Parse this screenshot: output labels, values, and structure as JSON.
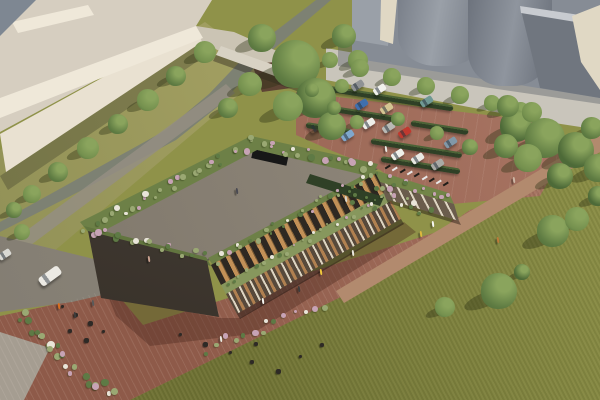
{
  "meta": {
    "type": "architectural-aerial-rendering",
    "description": "Aerial visualization of an elongated two-storey timber-bay building with a planted green roof, outdoor terrace, brick promenade, parking lot with hedgerows, stream with bridge, industrial silos and a large lawn"
  },
  "palette": {
    "grassA": "#6e7134",
    "grassB": "#8f9249",
    "grassPath": "#b28a6e",
    "brickA": "#8e5a49",
    "brickB": "#aa7765",
    "road": "#837d72",
    "roadLight": "#948e83",
    "cornerPath": "#a59d91",
    "greenwayA": "#b3ad6c",
    "greenwayB": "#8f8f55",
    "water": "#7d8173",
    "creamRoof": "#d6cec0",
    "creamLight": "#efe8d9",
    "creamFace": "#e9e1d1",
    "annex": "#cbc4b4",
    "bridge": "#d8d2c4",
    "hut": "#5e4434",
    "siloA": "#868c95",
    "siloB": "#70767f",
    "siloC": "#9aa0a8",
    "siloLight": "#c8cbd0",
    "siloCream": "#e0d8c4",
    "apron": "#c9c5bb",
    "roofDeckA": "#958d80",
    "roofDeckB": "#7d7569",
    "roofEdge": "#5f584e",
    "roofBand": "#6d8047",
    "skylight": "#171717",
    "timber": "#c29057",
    "timberDark": "#7d5c34",
    "midBand": "#87975d",
    "colonnade": "#57493b",
    "pillar": "#ddd4c1",
    "arch": "#b08050",
    "wingTop": "#728548",
    "wingBase": "#6a5c4c",
    "hedgeDark": "#2f4026",
    "hedgeLight": "#4c6337",
    "treeDark": "#4d6a38",
    "treeMid": "#5f7c43",
    "treeLight": "#74904e",
    "treeHi": "#8aa45d",
    "treeShadow": "rgba(43,48,18,0.38)",
    "shrubPink": "#c7a3b5",
    "shrubWhite": "#e9e5d9",
    "shrubSage": "#9aa873",
    "shrubGreen": "#5e7a45",
    "furniture": "#2e2a26",
    "bikeDark": "#1f1c18",
    "bikeLight": "#e8e8e8"
  },
  "scene": {
    "trees": [
      [
        262,
        38,
        14,
        1
      ],
      [
        296,
        64,
        24,
        1
      ],
      [
        316,
        98,
        20,
        0
      ],
      [
        288,
        106,
        15,
        2
      ],
      [
        332,
        126,
        14,
        1
      ],
      [
        344,
        36,
        12,
        1
      ],
      [
        358,
        60,
        10,
        2
      ],
      [
        250,
        84,
        12,
        2
      ],
      [
        228,
        108,
        10,
        1
      ],
      [
        205,
        52,
        11,
        2
      ],
      [
        176,
        76,
        10,
        1
      ],
      [
        148,
        100,
        11,
        2
      ],
      [
        118,
        124,
        10,
        1
      ],
      [
        88,
        148,
        11,
        2
      ],
      [
        58,
        172,
        10,
        1
      ],
      [
        32,
        194,
        9,
        2
      ],
      [
        14,
        210,
        8,
        1
      ],
      [
        22,
        232,
        8,
        2
      ],
      [
        330,
        60,
        8,
        2
      ],
      [
        360,
        68,
        9,
        2
      ],
      [
        392,
        77,
        9,
        2
      ],
      [
        426,
        86,
        9,
        2
      ],
      [
        460,
        95,
        9,
        2
      ],
      [
        492,
        103,
        8,
        2
      ],
      [
        521,
        110,
        8,
        2
      ],
      [
        312,
        90,
        7,
        1
      ],
      [
        342,
        86,
        7,
        2
      ],
      [
        334,
        108,
        7,
        1
      ],
      [
        357,
        122,
        7,
        2
      ],
      [
        398,
        119,
        7,
        1
      ],
      [
        437,
        133,
        7,
        2
      ],
      [
        470,
        147,
        8,
        1
      ],
      [
        516,
        126,
        16,
        0
      ],
      [
        545,
        138,
        20,
        1
      ],
      [
        576,
        150,
        18,
        0
      ],
      [
        598,
        168,
        14,
        1
      ],
      [
        528,
        158,
        14,
        2
      ],
      [
        506,
        146,
        12,
        1
      ],
      [
        560,
        176,
        13,
        0
      ],
      [
        592,
        128,
        11,
        1
      ],
      [
        508,
        106,
        11,
        1
      ],
      [
        532,
        112,
        10,
        2
      ],
      [
        598,
        196,
        10,
        0
      ],
      [
        553,
        231,
        16,
        1
      ],
      [
        577,
        219,
        12,
        2
      ],
      [
        499,
        291,
        18,
        1
      ],
      [
        445,
        307,
        10,
        2
      ],
      [
        522,
        272,
        8,
        0
      ]
    ],
    "hedges": [
      [
        305,
        82,
        150
      ],
      [
        333,
        106,
        66
      ],
      [
        411,
        120,
        58
      ],
      [
        306,
        122,
        46
      ],
      [
        371,
        138,
        92
      ],
      [
        381,
        156,
        80
      ]
    ],
    "shrub_bands": [
      [
        86,
        228,
        252,
        142,
        26,
        6,
        1.0
      ],
      [
        252,
        142,
        372,
        168,
        18,
        5,
        1.0
      ],
      [
        212,
        262,
        374,
        172,
        24,
        4,
        0.8
      ],
      [
        88,
        230,
        206,
        258,
        16,
        5,
        0.9
      ],
      [
        222,
        286,
        386,
        196,
        22,
        3,
        0.6
      ],
      [
        376,
        176,
        450,
        198,
        10,
        4,
        0.7
      ],
      [
        18,
        316,
        62,
        356,
        12,
        8,
        1.1
      ],
      [
        62,
        356,
        112,
        398,
        12,
        8,
        1.1
      ],
      [
        200,
        350,
        330,
        302,
        14,
        6,
        0.9
      ],
      [
        336,
        188,
        374,
        208,
        8,
        5,
        0.8
      ],
      [
        378,
        186,
        430,
        216,
        12,
        5,
        0.8
      ]
    ],
    "cars": [
      [
        300,
        97,
        "#9d9d99"
      ],
      [
        357,
        85,
        "#8f9294"
      ],
      [
        379,
        89,
        "#f1f1ec"
      ],
      [
        361,
        104,
        "#3f6fae"
      ],
      [
        386,
        108,
        "#d4c491"
      ],
      [
        426,
        101,
        "#6f9894"
      ],
      [
        315,
        127,
        "#ececе7"
      ],
      [
        347,
        135,
        "#7fa7cc"
      ],
      [
        368,
        123,
        "#efefe9"
      ],
      [
        388,
        127,
        "#b9b9b4"
      ],
      [
        404,
        132,
        "#c0392f"
      ],
      [
        450,
        142,
        "#8198a8"
      ],
      [
        397,
        154,
        "#f0f0ea"
      ],
      [
        417,
        158,
        "#e9e9e3"
      ],
      [
        437,
        164,
        "#a9aaa5"
      ],
      [
        4,
        254,
        "#d9d9d4"
      ]
    ],
    "van": [
      50,
      276,
      "#eceae4"
    ],
    "bikes": {
      "x": 387,
      "y": 164,
      "count": 9,
      "dx": 7.3,
      "dy": 2.1
    },
    "furniture": [
      [
        62,
        306
      ],
      [
        76,
        315
      ],
      [
        90,
        323
      ],
      [
        103,
        331
      ],
      [
        70,
        331
      ],
      [
        86,
        340
      ],
      [
        230,
        352
      ],
      [
        252,
        362
      ],
      [
        278,
        371
      ],
      [
        300,
        356
      ],
      [
        322,
        345
      ],
      [
        205,
        344
      ],
      [
        180,
        334
      ],
      [
        256,
        344
      ]
    ],
    "people": [
      [
        148,
        256,
        "#c9a18f"
      ],
      [
        236,
        188,
        "#4a4a52"
      ],
      [
        220,
        336,
        "#e8e6df"
      ],
      [
        262,
        298,
        "#f5f4ef"
      ],
      [
        320,
        269,
        "#f0c83c"
      ],
      [
        352,
        250,
        "#eae7de"
      ],
      [
        420,
        231,
        "#ddb83e"
      ],
      [
        432,
        221,
        "#f7f7f3"
      ],
      [
        497,
        237,
        "#bd7a39"
      ],
      [
        513,
        177,
        "#cdb6a4"
      ],
      [
        58,
        303,
        "#d96f1e"
      ],
      [
        74,
        312,
        "#3d3d3d"
      ],
      [
        92,
        300,
        "#5a5a5a"
      ],
      [
        298,
        286,
        "#3c3c3c"
      ],
      [
        385,
        146,
        "#e8e8e2"
      ],
      [
        345,
        196,
        "#d8d5cc"
      ]
    ]
  }
}
